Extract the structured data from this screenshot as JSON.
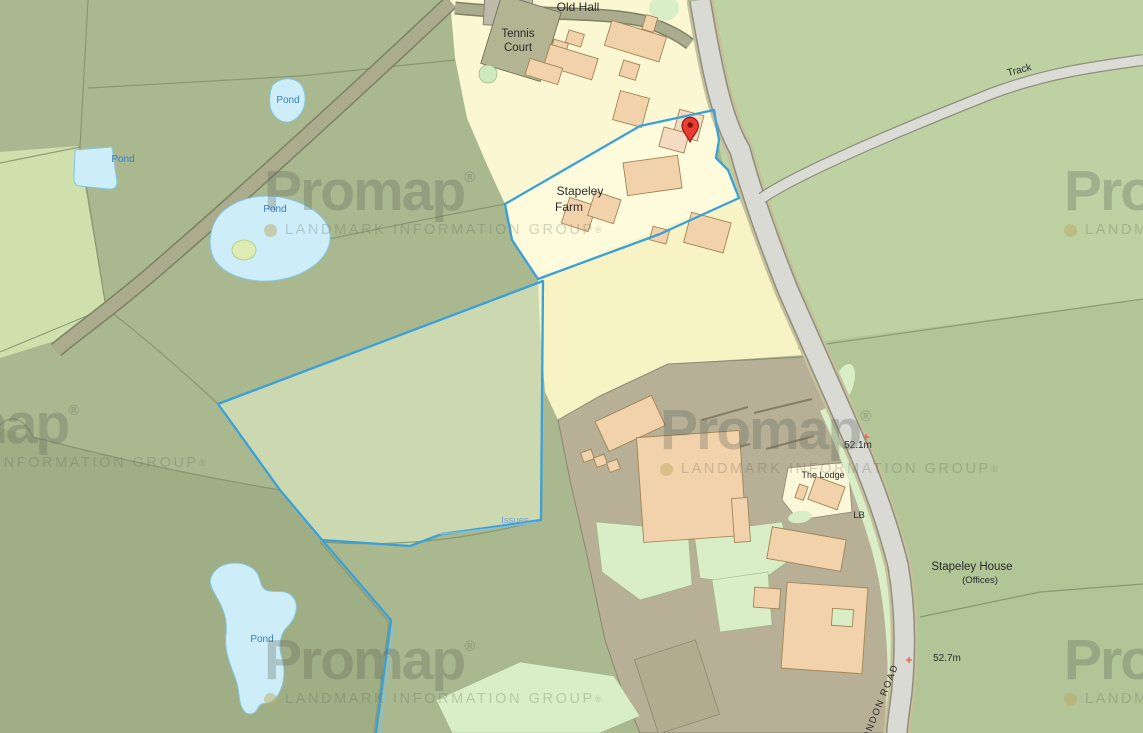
{
  "watermark": {
    "brand": "Promap",
    "reg": "®",
    "tagline": "LANDMARK INFORMATION GROUP"
  },
  "labels": {
    "old_hall": "Old Hall",
    "tennis_court": {
      "line1": "Tennis",
      "line2": "Court"
    },
    "stapeley_farm": {
      "line1": "Stapeley",
      "line2": "Farm"
    },
    "pond": "Pond",
    "issues": "Issues",
    "track": "Track",
    "spot_height_north": "52.1m",
    "spot_height_south": "52.7m",
    "the_lodge": "The Lodge",
    "lb": "LB",
    "stapeley_house": "Stapeley House",
    "stapeley_house_sub": "(Offices)",
    "london_road": "LONDON ROAD"
  },
  "marker": {
    "type": "location-pin",
    "color": "#e93d32"
  },
  "colors": {
    "field_green": "#a9b88f",
    "light_field_green": "#bdd1a2",
    "se_grounds_green": "#b1c596",
    "dark_field_green": "#9fae85",
    "pale_field": "#cfe0ad",
    "selected_field_sage": "#cbd8b0",
    "farm_cream": "#fbf7d3",
    "selected_cream": "#fdfbdc",
    "yellow_parcel": "#f8f3c5",
    "building_peach": "#f2d2aa",
    "hardstanding": "#b7b096",
    "garden_mint": "#d9eec6",
    "road_gray": "#d9dad4",
    "pond_blue": "#cdeef8",
    "selection_blue": "#3aa0d8",
    "pin_red": "#e93d32",
    "watermark_gray": "#5c625a"
  }
}
